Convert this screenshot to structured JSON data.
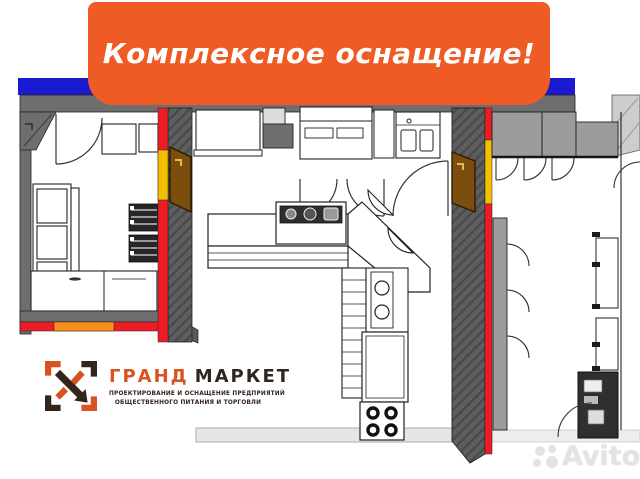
{
  "banner": {
    "text": "Комплексное оснащение!",
    "bg_color": "#EF5B25",
    "text_color": "#FFFFFF"
  },
  "header_bar": {
    "color": "#1A1AD0"
  },
  "plan": {
    "type": "commercial-kitchen-floor-plan",
    "colors": {
      "wall_gray": "#6E6E6E",
      "wall_dark_gray": "#5E5E5E",
      "wall_red": "#EE1C25",
      "wall_yellow": "#F3C000",
      "wall_orange_segment": "#F78F1E",
      "door_brown": "#7C4E0E",
      "equipment_white": "#FFFFFF",
      "equipment_dark": "#2E2E2E",
      "floor_light": "#E6E6E6",
      "outline": "#222222"
    }
  },
  "logo": {
    "name_primary": "ГРАНД",
    "name_secondary": "МАРКЕТ",
    "tagline_line1": "ПРОЕКТИРОВАНИЕ И ОСНАЩЕНИЕ ПРЕДПРИЯТИЙ",
    "tagline_line2": "ОБЩЕСТВЕННОГО ПИТАНИЯ И ТОРГОВЛИ",
    "primary_color": "#D8531F",
    "secondary_color": "#33241C",
    "icon": "grand-market-corner-bracket-mark"
  },
  "watermark": {
    "text": "Avito",
    "icon": "avito-four-dots",
    "color": "#E3E3E3"
  }
}
